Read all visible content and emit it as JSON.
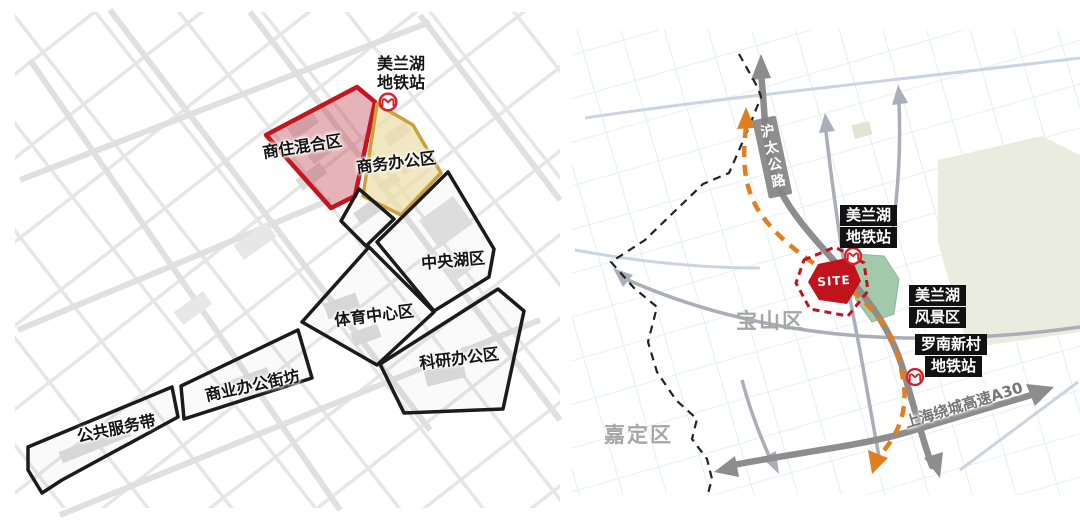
{
  "left_panel": {
    "station": {
      "line1": "美兰湖",
      "line2": "地铁站"
    },
    "zones": {
      "mixed": "商住混合区",
      "business": "商务办公区",
      "central_lake": "中央湖区",
      "sports": "体育中心区",
      "research": "科研办公区",
      "commercial_street": "商业办公街坊",
      "public_service": "公共服务带"
    }
  },
  "right_panel": {
    "station_meilanhu": {
      "line1": "美兰湖",
      "line2": "地铁站"
    },
    "scenic": {
      "line1": "美兰湖",
      "line2": "风景区"
    },
    "station_luonan": {
      "line1": "罗南新村",
      "line2": "地铁站"
    },
    "districts": {
      "baoshan": "宝山区",
      "jiading": "嘉定区"
    },
    "roads": {
      "hutai": "沪太公路",
      "ring": "上海绕城高速A30"
    },
    "site": "SITE"
  },
  "colors": {
    "zone_red_border": "#c4161f",
    "zone_red_fill": "rgba(193,68,78,0.40)",
    "zone_yellow_border": "#c9a23b",
    "zone_yellow_fill": "rgba(235,222,168,0.72)",
    "zone_black_border": "#1b1b1b",
    "metro_line_orange": "#e17f20",
    "road_dark": "#8d8d8d",
    "road_secondary": "#a9aeb9",
    "park_green": "#e9ecdf",
    "scenic_green": "#a3c9ad",
    "metro_logo_red": "#d2232a",
    "site_red": "#c0131c"
  }
}
